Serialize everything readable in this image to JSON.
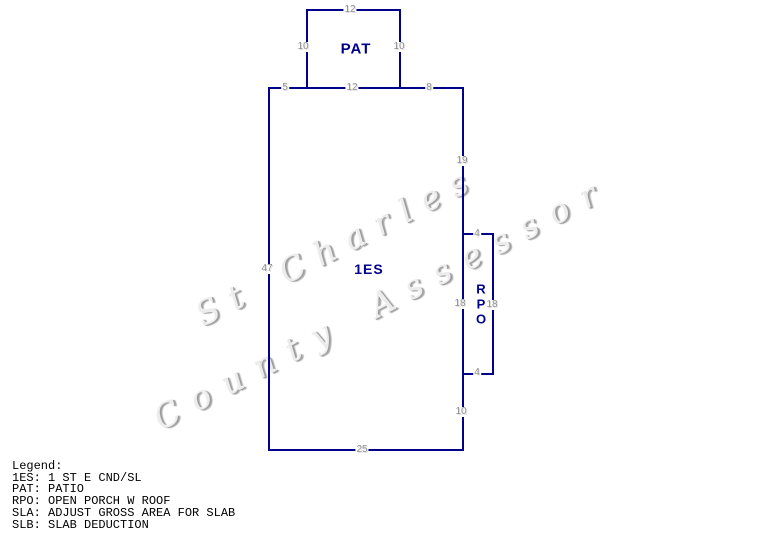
{
  "watermark": {
    "line1": "St Charles",
    "line2": "County Assessor"
  },
  "sketch": {
    "line_color": "#00008B",
    "dim_color": "#8f8f8f",
    "area_label_color": "#00008B",
    "areas": {
      "patio_label": "PAT",
      "main_label": "1ES",
      "porch_label": "RPO"
    },
    "dims": {
      "patio_top": "12",
      "patio_left": "10",
      "patio_right": "10",
      "main_top_left": "5",
      "main_top_mid": "12",
      "main_top_right": "8",
      "right_upper": "19",
      "left_side": "47",
      "rpo_top": "4",
      "rpo_left": "18",
      "rpo_right": "18",
      "rpo_bottom": "4",
      "right_lower": "10",
      "bottom": "25"
    }
  },
  "legend": {
    "title": "Legend:",
    "entries": [
      {
        "abbr": "1ES:",
        "desc": "1 ST E CND/SL"
      },
      {
        "abbr": "PAT:",
        "desc": "PATIO"
      },
      {
        "abbr": "RPO:",
        "desc": "OPEN PORCH W ROOF"
      },
      {
        "abbr": "SLA:",
        "desc": "ADJUST GROSS AREA FOR SLAB"
      },
      {
        "abbr": "SLB:",
        "desc": "SLAB DEDUCTION"
      }
    ]
  }
}
